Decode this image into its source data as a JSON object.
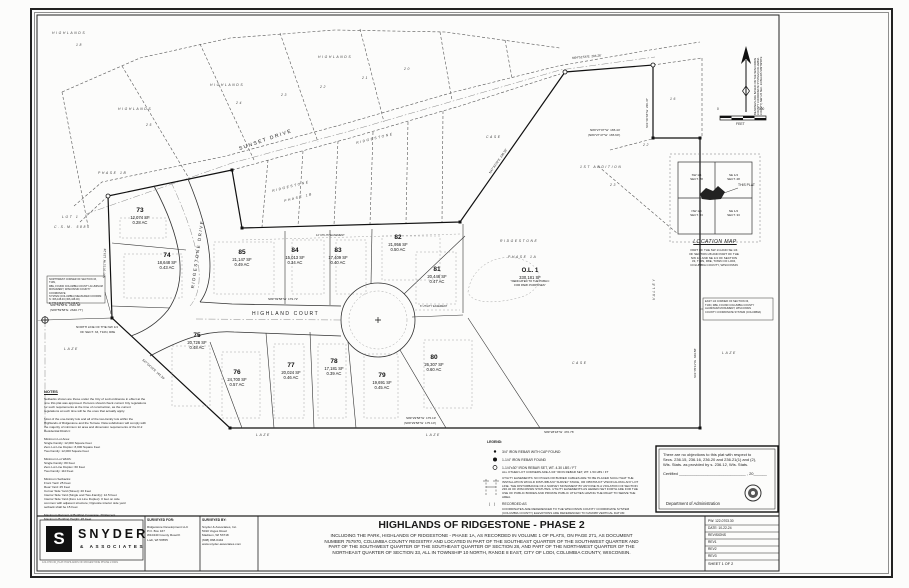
{
  "title_block": {
    "title": "HIGHLANDS OF RIDGESTONE - PHASE 2",
    "subtitle": "INCLUDING THE PARK, HIGHLANDS OF RIDGESTONE - PHASE 1A, AS RECORDED IN VOLUME 1 OF PLATS, ON PAGE 271, AS DOCUMENT\nNUMBER 757970, COLUMBIA COUNTY REGISTRY AND LOCATED IN PART OF THE SOUTHEAST QUARTER OF THE SOUTHWEST QUARTER AND\nPART OF THE SOUTHWEST QUARTER OF THE SOUTHEAST QUARTER OF SECTION 28, AND PART OF THE NORTHWEST QUARTER OF THE\nNORTHEAST QUARTER OF SECTION 33, ALL IN TOWNSHIP 10 NORTH, RANGE 8 EAST, CITY OF LODI, COLUMBIA COUNTY, WISCONSIN."
  },
  "branding": {
    "logo_letter": "S",
    "name": "SNYDER",
    "sub": "& ASSOCIATES",
    "plot_ref": "122-0703.30_PLAT-HIGHLANDS OF RIDGESTONE PHASE 2.DWG"
  },
  "surveyed_for": {
    "label": "SURVEYED FOR:",
    "body": "Ridgestone Development LLC\nP.O. Box 167\nW10440 County Road K\nLodi, WI 53555"
  },
  "surveyed_by": {
    "label": "SURVEYED BY:",
    "body": "Snyder & Associates, Inc.\n5010 Voges Road\nMadison, WI 53718\n(608) 838-0444\nwww.snyder-associates.com"
  },
  "info_box": {
    "pw": "PW: 122-0703.30",
    "date": "DATE: 10-22-24",
    "revisions": "REVISIONS",
    "rev1": "REV1",
    "rev2": "REV2",
    "rev3": "REV3",
    "sheet_no": "SHEET 1 OF 2"
  },
  "notes": {
    "title": "NOTES",
    "body": "Setbacks shown are those under the City of Lodi ordinance in effect at the\ntime this plat was approved. Persons should check current City regulations\nfor such requirements at the time of construction, as the current\nregulations at such time will be the ones that actually apply.\n\nMost of the one-family lots and all of the two-family lots within the\nHighlands of Ridgestone and the Terrace Vista subdivision will comply with\nthe majority of minimum lot area and dimension requirements of the R-2\nResidential District:\n\nMinimum Lot Area:\n      Single Family: 12,000 Square Feet\n      Zero Lot Line Duplex: 8,000 Square Feet\n      Two Family: 12,000 Square Feet\n\nMinimum Lot Width:\n      Single Family: 80 Feet\n      Zero Lot Line Duplex: 60 Feet\n      Two Family: 110 Feet\n\nMinimum Setbacks:\n      Front Yard: 25 Feet\n      Rear Yard: 25 Feet\n      Corner Side Yard (Street): 20 Feet\n      Interior Side Yard (Single and Two-Family): 12.5 Feet\n      Interior Side Yard (Zero Lot Line Duplex): 0 feet on side\n      common with adjacent structure; Opposite interior side yard\n      setback shall be 15 Feet\n\nMaximum Percent of Building Coverage: 30 Percent\nMaximum Building Height: 45 Feet"
  },
  "legend": {
    "title": "LEGEND:",
    "item1": "3/4\" IRON REBAR WITH CAP FOUND",
    "item2": "1-1/4\" IRON REBAR FOUND",
    "item3a": "1-1/4\"x30\" IRON REBAR SET, WT. 4.30 LBS / FT",
    "item3b": "ALL OTHER LOT CORNERS ARE A 3/4\" IRON REBAR SET, WT. 1.50 LBS / FT",
    "utility": "UTILITY EASEMENTS: NO POLES OR BURIED CABLES ARE TO BE PLACED SUCH THAT THE\nINSTALLATION WOULD DISTURB ANY SURVEY STAKE, OR OBSTRUCT VISION ALONG ANY LOT\nLINE. THE DISTURBANCE OF A SURVEY MONUMENT BY ANYONE IS A VIOLATION OF SECTION\n236.32 OF WISCONSIN STATUTES. UTILITY EASEMENTS AS HEREIN SET FORTH ARE FOR THE\nUSE OF PUBLIC BODIES AND PRIVATE PUBLIC UTILITIES HAVING THE RIGHT TO SERVE THE\nAREA.",
    "recorded_sym": "(    )",
    "recorded": "RECORDED AS",
    "coords": "COORDINATES ARE REFERENCED TO THE WISCONSIN COUNTY COORDINATE SYSTEM\n(COLUMBIA COUNTY) ELEVATIONS ARE REFERENCED TO NAVD88 VERTICAL DATUM"
  },
  "certification": {
    "body": "There are no objections to this plat with respect to\nSecs. 236.15, 236.16, 236.20 and 236.21(1) and (2),\nWis. Stats. as provided by s. 236.12, Wis. Stats.",
    "certified": "Certified ______________________________ , 20______",
    "dept": "Department of Administration"
  },
  "location_map": {
    "title": "LOCATION MAP",
    "nw": "SW 1/4\nSECT. 28",
    "ne": "SE 1/4\nSECT. 28",
    "sw": "NW 1/4\nSECT. 33",
    "se": "NE 1/4\nSECT. 33",
    "this_plat": "THIS PLAT",
    "caption": "PART OF THE SW 1/4 AND SE 1/4\nOF SECTION 28 AND PART OF THE\nNW 1/4 AND NE 1/4 OF SECTION\n33, T10N, R8E, TOWN OF LODI,\nCOLUMBIA COUNTY, WISCONSIN"
  },
  "compass": {
    "note": "BEARINGS ARE BASED ON THE WISCONSIN\nCOUNTY COORDINATE SYSTEM (COLUMBIA\nCOUNTY) NW 1/4 SEC. 33 BEARS S89°59'58\"E",
    "zero": "0",
    "hundred": "100",
    "unit": "FEET"
  },
  "monuments": {
    "left": "NORTHWEST CORNER OF SECTION 33, T10N,\nR8E, FOUND COLUMBIA COUNTY ALUMINUM\nMONUMENT, WISCONSIN COUNTY COORDINATE\nSYSTEM (COLUMBIA) MEASURED COORDS:\nN: 306,448.46   (306,448.46)\nE: 774,443.27   (774,443.27)",
    "right": "EAST 1/4 CORNER OF SECTION 33,\nT10N, R8E, FOUND COLUMBIA COUNTY\nALUMINUM MONUMENT, WISCONSIN\nCOUNTY COORDINATE SYSTEM (COLUMBIA)"
  },
  "streets": {
    "sunset": "SUNSET DRIVE",
    "ridgestone": "RIDGESTONE DRIVE",
    "highland": "HIGHLAND COURT"
  },
  "outlot": {
    "name": "O.L. 1",
    "sf": "330,181 SF",
    "note": "\"DEDICATED TO THE PUBLIC\nFOR PARK PURPOSES\""
  },
  "lots": [
    {
      "number": "73",
      "sf": "12,074 SF",
      "ac": "0.28 AC"
    },
    {
      "number": "74",
      "sf": "18,648 SF",
      "ac": "0.43 AC"
    },
    {
      "number": "75",
      "sf": "20,726 SF",
      "ac": "0.48 AC"
    },
    {
      "number": "76",
      "sf": "24,700 SF",
      "ac": "0.57 AC"
    },
    {
      "number": "77",
      "sf": "20,024 SF",
      "ac": "0.46 AC"
    },
    {
      "number": "78",
      "sf": "17,181 SF",
      "ac": "0.39 AC"
    },
    {
      "number": "79",
      "sf": "19,691 SF",
      "ac": "0.45 AC"
    },
    {
      "number": "80",
      "sf": "26,307 SF",
      "ac": "0.60 AC"
    },
    {
      "number": "81",
      "sf": "20,446 SF",
      "ac": "0.47 AC"
    },
    {
      "number": "82",
      "sf": "21,956 SF",
      "ac": "0.50 AC"
    },
    {
      "number": "83",
      "sf": "17,409 SF",
      "ac": "0.40 AC"
    },
    {
      "number": "84",
      "sf": "15,013 SF",
      "ac": "0.34 AC"
    },
    {
      "number": "85",
      "sf": "21,147 SF",
      "ac": "0.49 AC"
    }
  ],
  "adjacent": [
    "HIGHLANDS",
    "25",
    "HIGHLANDS",
    "24",
    "23",
    "22",
    "21",
    "20",
    "HIGHLANDS",
    "18",
    "HIGHLANDS",
    "16",
    "22",
    "1ST ADDITION",
    "23",
    "LOT 1",
    "C.S.M. 5885",
    "LAZE",
    "LAZE",
    "LAZE",
    "LAZE",
    "CASE",
    "CASE",
    "VALLEY",
    "PHASE 1B",
    "RIDGESTONE",
    "PHASE 1B",
    "RIDGESTONE",
    "RIDGESTONE",
    "PHASE 1A"
  ],
  "bearings": [
    "S89°59'58\"E  2640.68'",
    "(S89°59'58\"E  2640.77')",
    "NORTH LINE OF THE NW 1/4",
    "OF SECT. 33, T10N, R8E",
    "S89°39'58\"W  179.72'",
    "N89°27'07\"W  165.44'",
    "(N89°27'47\"W  165.60')",
    "S01°05'11\"W  329.58'",
    "S01°00'33\"W  220.47'",
    "N47°32'29\"E  236.39'",
    "N64°51'54\"E  204.26'",
    "S89°29'58\"W  175.19'",
    "(S89°29'58\"W  175.10')",
    "S00°30'31\"W  123.24'",
    "12' UTILITY EASEMENT",
    "6' UTILITY EASEMENT",
    "S89°28'18\"W  470.76'",
    "S47°04'19\"E  161.29'"
  ]
}
